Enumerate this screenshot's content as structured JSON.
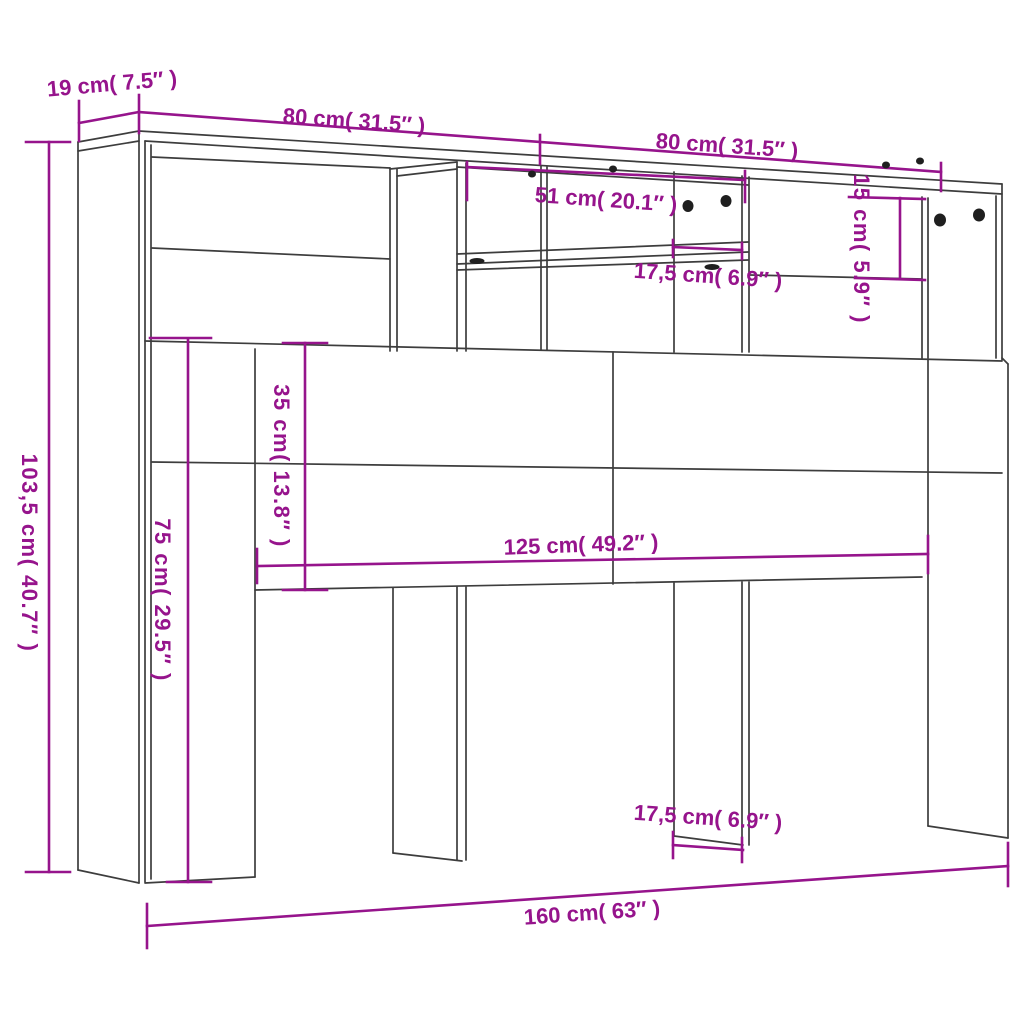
{
  "diagram": {
    "subject": "headboard cabinet dimension drawing",
    "view": "front perspective line art",
    "colors": {
      "dimension_accent": "#96148c",
      "outline": "#3d3d3d",
      "hardware": "#1f1f1f",
      "background": "#ffffff"
    },
    "dimensions": [
      {
        "id": "depth-top-left",
        "label": "19 cm( 7.5″ )"
      },
      {
        "id": "top-width-left-half",
        "label": "80 cm( 31.5″ )"
      },
      {
        "id": "top-width-right-half",
        "label": "80 cm( 31.5″ )"
      },
      {
        "id": "open-shelf-width",
        "label": "51 cm( 20.1″ )"
      },
      {
        "id": "compartment-width-top",
        "label": "17,5 cm( 6.9″ )"
      },
      {
        "id": "right-compartment-height",
        "label": "15 cm( 5.9″ )"
      },
      {
        "id": "total-height",
        "label": "103,5 cm( 40.7″ )"
      },
      {
        "id": "leg-height",
        "label": "75 cm( 29.5″ )"
      },
      {
        "id": "panel-height",
        "label": "35 cm( 13.8″ )"
      },
      {
        "id": "panel-width",
        "label": "125 cm( 49.2″ )"
      },
      {
        "id": "leg-width-bottom",
        "label": "17,5 cm( 6.9″ )"
      },
      {
        "id": "total-width",
        "label": "160 cm( 63″ )"
      }
    ]
  }
}
